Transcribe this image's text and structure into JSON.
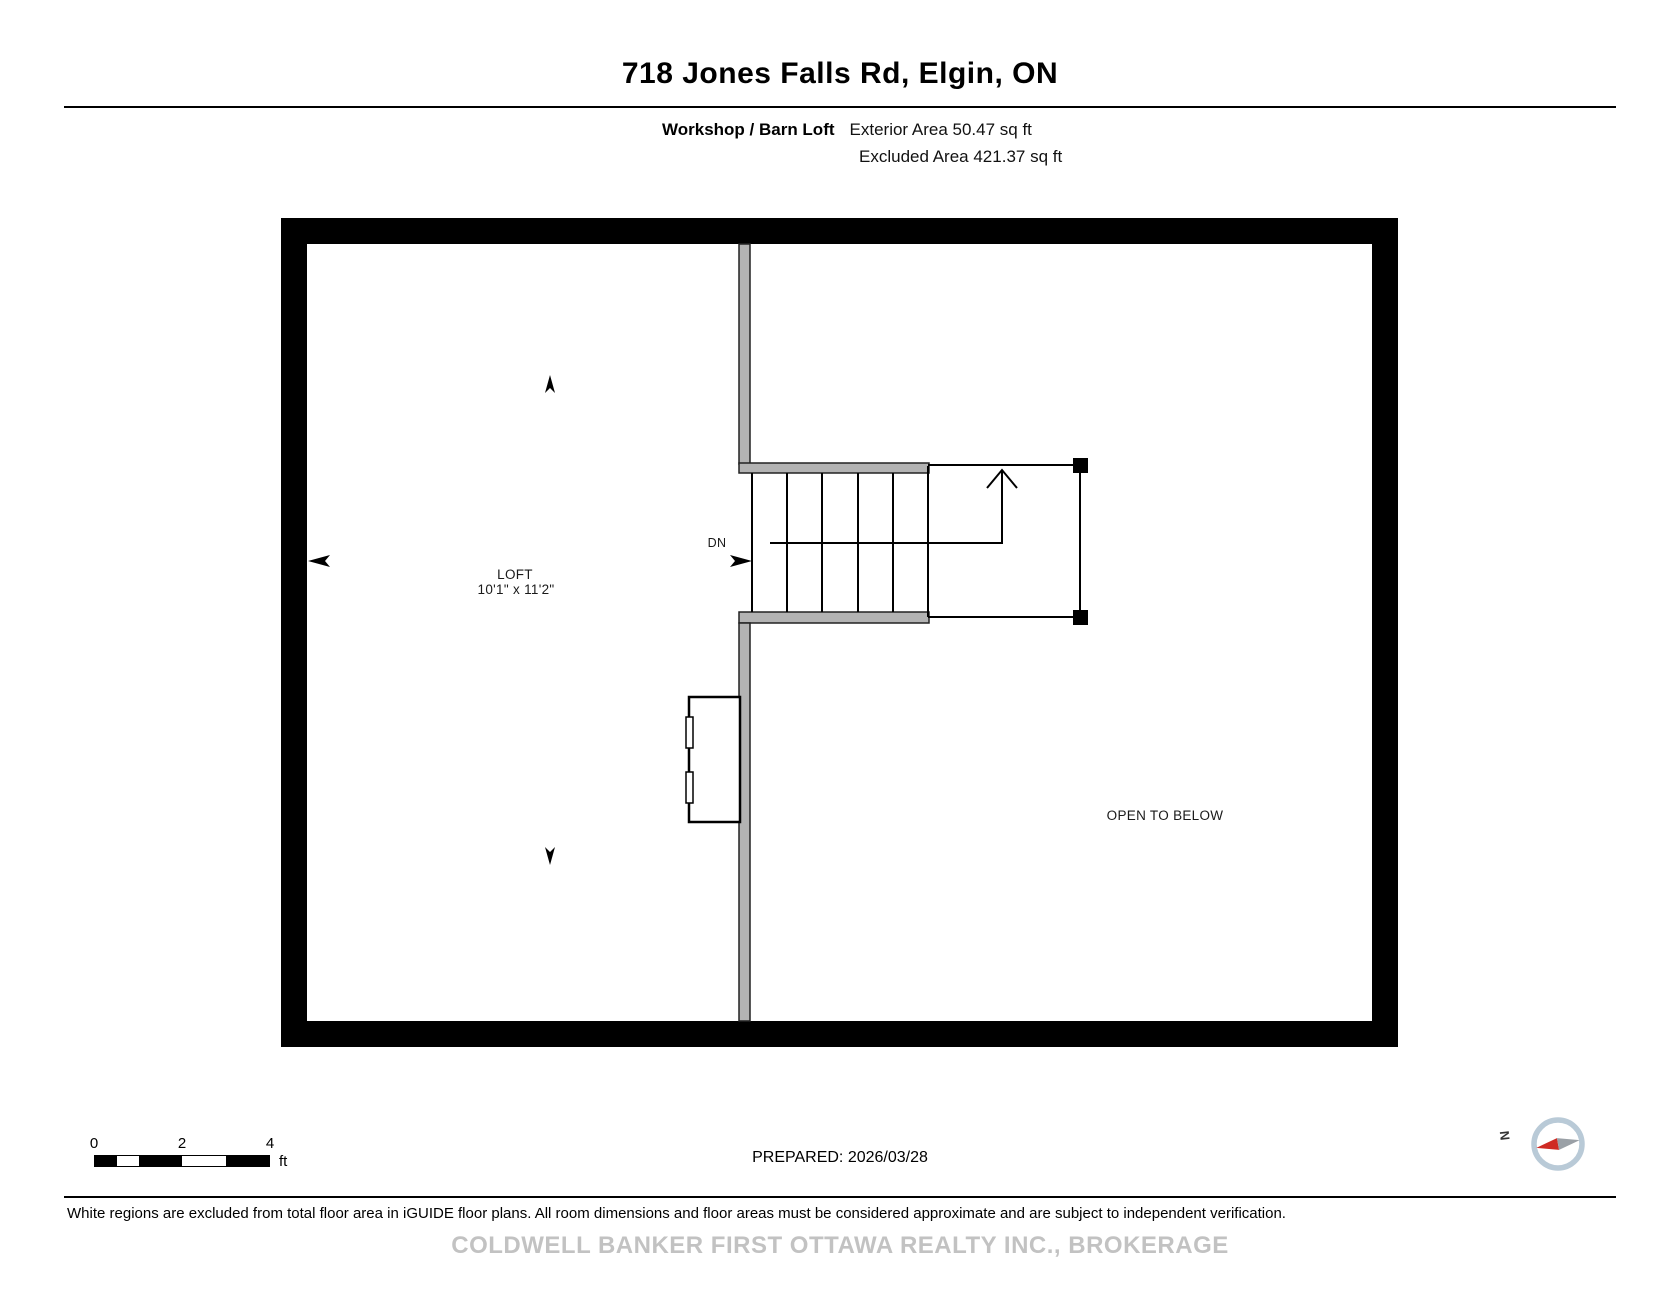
{
  "header": {
    "title": "718 Jones Falls Rd, Elgin, ON",
    "floor_label": "Workshop / Barn Loft",
    "exterior_area": "Exterior Area 50.47 sq ft",
    "excluded_area": "Excluded Area 421.37 sq ft"
  },
  "plan": {
    "room": {
      "name": "LOFT",
      "dims": "10'1\" x 11'2\""
    },
    "stair_label": "DN",
    "open_to_below": "OPEN TO BELOW",
    "colors": {
      "outer_wall": "#000000",
      "partition_fill": "#b3b3b3",
      "line": "#000000"
    }
  },
  "footer": {
    "scale": {
      "ticks": [
        "0",
        "2",
        "4"
      ],
      "unit": "ft"
    },
    "prepared": "PREPARED: 2026/03/28",
    "compass": {
      "label": "N",
      "ring_color": "#b9cad7",
      "north_color": "#cf2b24",
      "south_color": "#9aa0a6"
    },
    "disclaimer": "White regions are excluded from total floor area in iGUIDE floor plans. All room dimensions and floor areas must be considered approximate and are subject to independent verification.",
    "watermark": "COLDWELL BANKER FIRST OTTAWA REALTY INC., BROKERAGE"
  }
}
